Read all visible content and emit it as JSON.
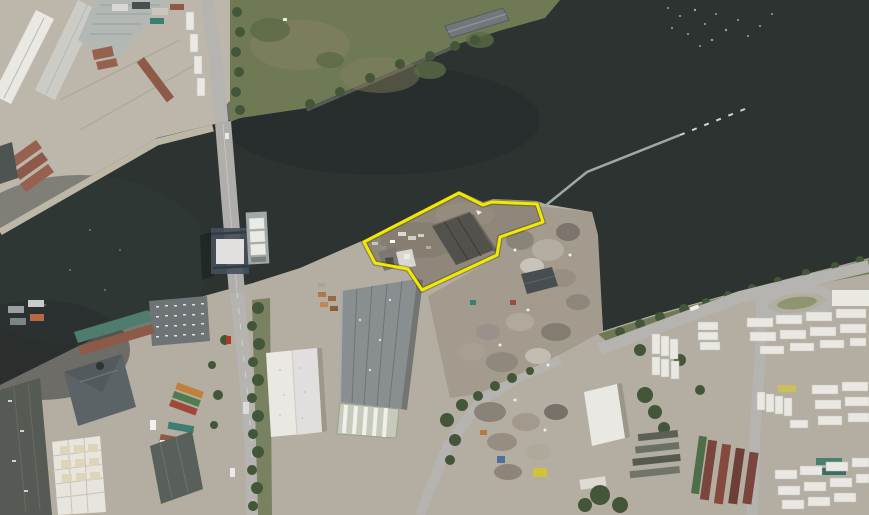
{
  "image": {
    "kind": "aerial-photograph",
    "description": "Aerial photo of an industrial riverside area. A dark river crosses the frame; a vertical-lift bridge spans it on the left. A waterfront parcel on the south bank is outlined in yellow, flanked by a scrap-metal yard, warehouses and container/trailer yards. A floating boom extends into the river from the parcel's north-east corner.",
    "annotation": {
      "label": "highlighted-site-boundary",
      "points": "364,242 459,193 483,205 492,202 537,204 543,222 500,237 497,255 422,290 408,269 375,263",
      "stroke_width": 3
    },
    "boom": {
      "solid_points": "545,206 587,172 680,135",
      "dashed_points": "680,135 750,107"
    },
    "palette": {
      "land": "#b4ada1",
      "land-light": "#c2bbaf",
      "water": "#2c3331",
      "green": "#6f7a55",
      "green-dark": "#435639",
      "road": "#b6b4b0",
      "roof-white": "#e9e8e3",
      "roof-grey": "#898f91",
      "roof-dark": "#53514b",
      "roof-red": "#96614e",
      "sand": "#cdc5b4",
      "site-ground": "#8f8779",
      "accent": "#f2e800",
      "boom": "#9fa8a6"
    }
  }
}
